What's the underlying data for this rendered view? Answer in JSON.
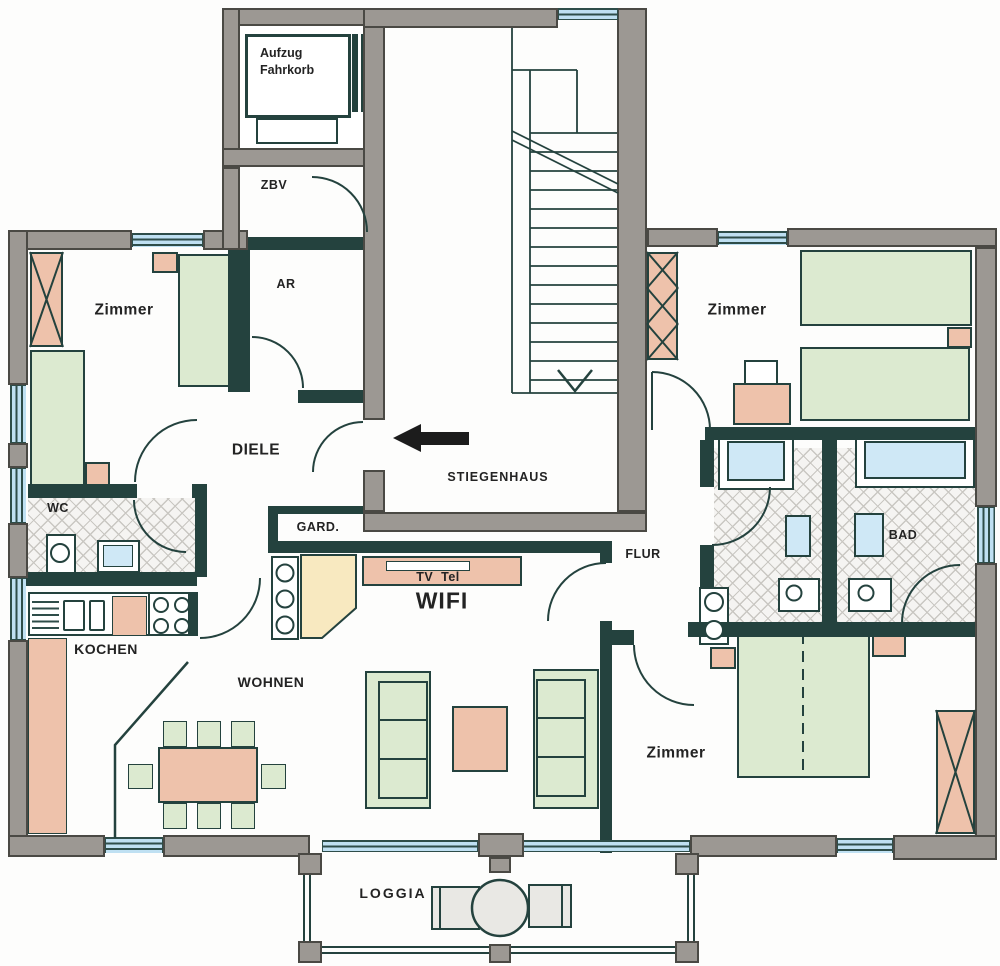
{
  "colors": {
    "wall_gray": "#9c9893",
    "line_dark": "#24423e",
    "furniture_green": "#dcead0",
    "furniture_pink": "#eec2ab",
    "window_blue": "#bfe0f2",
    "bathtub_blue": "#cfe8f6",
    "accent_yellow": "#f8e9c0",
    "floor_white": "#ffffff",
    "arrow_black": "#1c1c1c"
  },
  "floorplan": {
    "elevator": {
      "line1": "Aufzug",
      "line2": "Fahrkorb"
    },
    "rooms": {
      "zbv": "ZBV",
      "ar": "AR",
      "zimmer_nw": "Zimmer",
      "zimmer_ne": "Zimmer",
      "zimmer_se": "Zimmer",
      "diele": "DIELE",
      "stiegenhaus": "STIEGENHAUS",
      "wc": "WC",
      "gard": "GARD.",
      "kochen": "KOCHEN",
      "wohnen": "WOHNEN",
      "flur": "FLUR",
      "bad": "BAD",
      "loggia": "LOGGIA"
    },
    "annotations": {
      "tv_tel": "TV  Tel",
      "wifi": "WIFI"
    },
    "icons": {
      "entrance_direction": "left-arrow",
      "stairs_down": "down-chevron"
    }
  }
}
